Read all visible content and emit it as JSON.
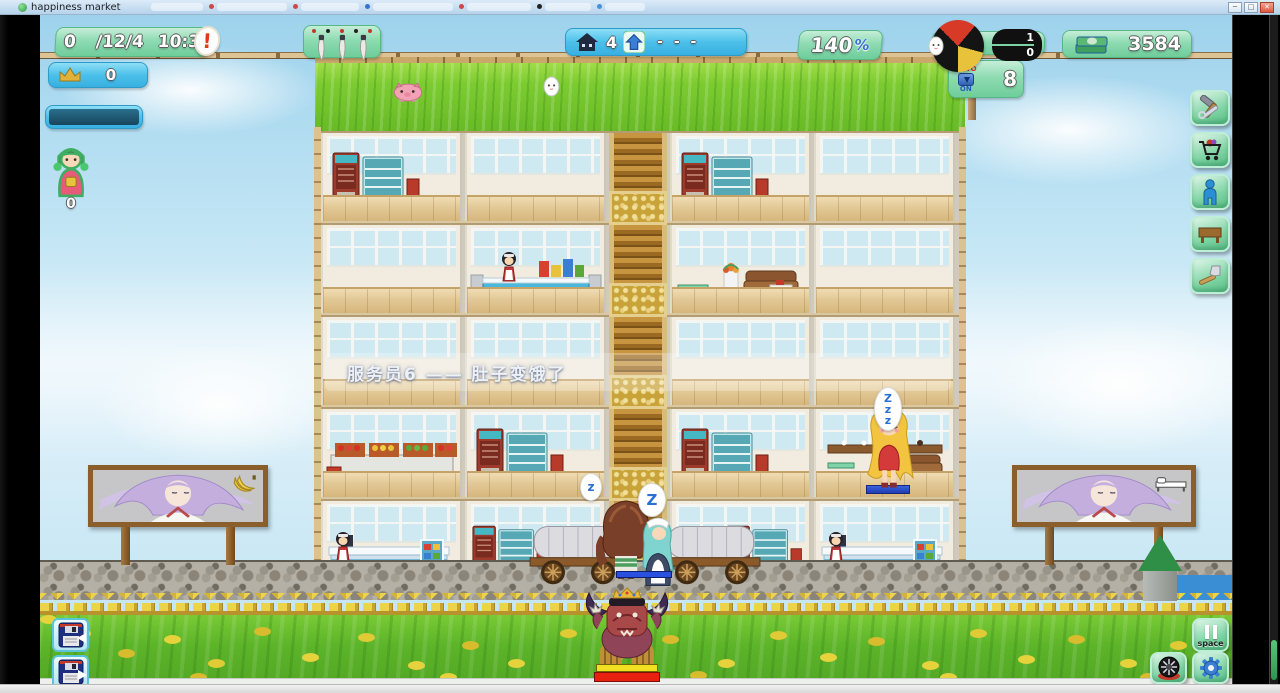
{
  "window": {
    "title": "happiness market",
    "controls": {
      "minimize": "─",
      "maximize": "□",
      "close": "✕"
    }
  },
  "hud": {
    "date_panel": {
      "counter": "0",
      "date": "/12/4",
      "time": "10:35",
      "alert": "!"
    },
    "crown_panel": {
      "value": "0"
    },
    "player": {
      "level": "0"
    },
    "building_panel": {
      "house_count": "4",
      "upgrade_value": "- - -"
    },
    "happiness_panel": {
      "value": "140",
      "unit": "%"
    },
    "ratio_panel": {
      "numerator": "1",
      "denominator": "0"
    },
    "auto_panel": {
      "top": "AUTO",
      "bottom": "ON",
      "count": "8"
    },
    "money_panel": {
      "amount": "3584"
    }
  },
  "toolbar": {
    "buttons": [
      {
        "id": "build-tools",
        "icon": "wrench-hammer-icon"
      },
      {
        "id": "shop-goods",
        "icon": "cart-icon"
      },
      {
        "id": "hire-staff",
        "icon": "person-icon"
      },
      {
        "id": "furniture",
        "icon": "table-icon"
      },
      {
        "id": "decorate",
        "icon": "axe-icon"
      }
    ]
  },
  "notification": {
    "text": "服务员6 —— 肚子变饿了"
  },
  "speech": {
    "z1": "z",
    "z2": "Z",
    "sleep": "Z\nz\nz"
  },
  "controls_bottom": {
    "save_buttons": [
      {
        "id": "save-slot",
        "icon": "floppy-icon"
      },
      {
        "id": "load-slot",
        "icon": "floppy-icon"
      }
    ],
    "pause": {
      "label": "space"
    },
    "camera": {
      "icon": "wheel-camera-icon"
    },
    "settings": {
      "icon": "gear-icon"
    }
  },
  "billboards": [
    {
      "side": "left",
      "ad": "bananas"
    },
    {
      "side": "right",
      "ad": "bed"
    }
  ],
  "building": {
    "floors": [
      {
        "label": "5F",
        "rooms": [
          {
            "type": "arcade",
            "sprites": [
              "vending"
            ]
          },
          {
            "type": "empty",
            "sprites": []
          },
          {
            "type": "arcade",
            "sprites": [
              "vending"
            ]
          },
          {
            "type": "empty",
            "sprites": []
          }
        ]
      },
      {
        "label": "4F",
        "rooms": [
          {
            "type": "empty",
            "sprites": []
          },
          {
            "type": "shop",
            "sprites": [
              "countershop",
              "maid"
            ]
          },
          {
            "type": "lounge",
            "sprites": [
              "lounge"
            ]
          },
          {
            "type": "empty",
            "sprites": []
          }
        ]
      },
      {
        "label": "3F",
        "rooms": [
          {
            "type": "empty",
            "sprites": []
          },
          {
            "type": "empty",
            "sprites": []
          },
          {
            "type": "empty",
            "sprites": []
          },
          {
            "type": "empty",
            "sprites": []
          }
        ]
      },
      {
        "label": "2F",
        "rooms": [
          {
            "type": "fruit",
            "sprites": [
              "fruit"
            ]
          },
          {
            "type": "arcade",
            "sprites": [
              "vending"
            ]
          },
          {
            "type": "arcade",
            "sprites": [
              "vending"
            ]
          },
          {
            "type": "lounge2",
            "sprites": [
              "loungemini"
            ]
          }
        ]
      },
      {
        "label": "1F",
        "rooms": [
          {
            "type": "checkout",
            "sprites": [
              "checkout",
              "maid",
              "shelf"
            ]
          },
          {
            "type": "salesL",
            "sprites": [
              "vending"
            ]
          },
          {
            "type": "salesR",
            "sprites": [
              "vending"
            ]
          },
          {
            "type": "checkout",
            "sprites": [
              "checkout",
              "maid",
              "shelf"
            ]
          }
        ]
      }
    ]
  },
  "colors": {
    "mint": "#7fd1a3",
    "blue": "#4cc0ea",
    "money_green": "#3f9f5c",
    "alert_red": "#e03c18"
  }
}
